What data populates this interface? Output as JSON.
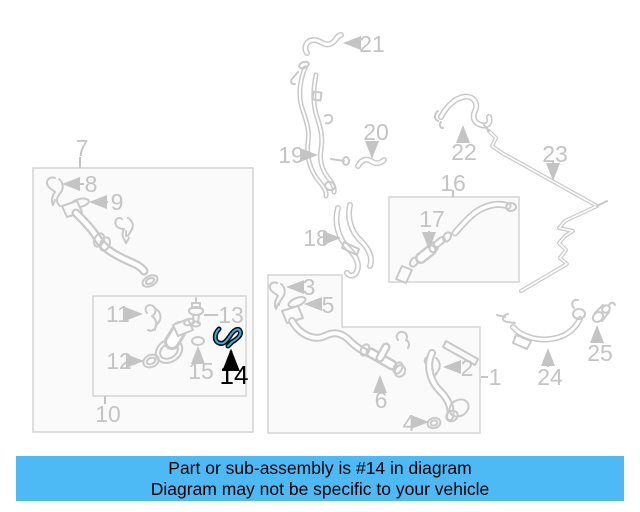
{
  "banner": {
    "line1": "Part or sub-assembly is #14 in diagram",
    "line2": "Diagram may not be specific to your vehicle"
  },
  "diagram": {
    "highlighted_part": "14",
    "colors": {
      "highlight_accent": "#2bb4e8",
      "highlight_stroke": "#000000",
      "line_gray": "#c9c9c9",
      "label_gray": "#c4c4c4",
      "banner_blue": "#4db9f5",
      "banner_text": "#000000"
    },
    "labels": {
      "1": "1",
      "2": "2",
      "3": "3",
      "4": "4",
      "5": "5",
      "6": "6",
      "7": "7",
      "8": "8",
      "9": "9",
      "10": "10",
      "11": "11",
      "12": "12",
      "13": "13",
      "14": "14",
      "15": "15",
      "16": "16",
      "17": "17",
      "18": "18",
      "19": "19",
      "20": "20",
      "21": "21",
      "22": "22",
      "23": "23",
      "24": "24",
      "25": "25"
    }
  }
}
